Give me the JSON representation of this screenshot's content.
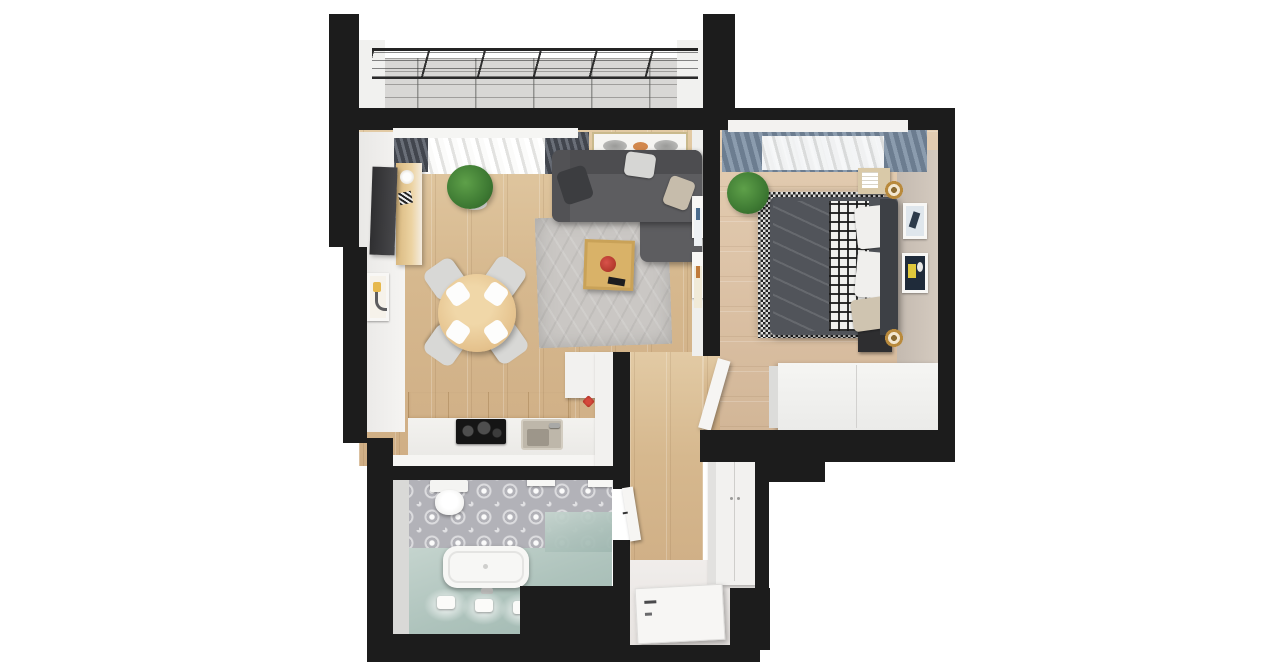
{
  "meta": {
    "title": "Top-down 3D floor plan of a one-bedroom apartment",
    "view": "top-down 3D render",
    "style": "white background, black wall mass"
  },
  "palette": {
    "wall_black": "#1c1c1c",
    "background_white": "#ffffff",
    "wood_living": "#d6b88e",
    "wood_bedroom": "#dcc2a6",
    "balcony_concrete": "#d8d7d5",
    "bathroom_tile_gray": "#b2b2b8",
    "shower_teal": "#aec3bc",
    "rug_gray": "#cac7c4",
    "sofa_gray": "#5d5d60",
    "bed_duvet_blue": "#7c93a6",
    "accent_red": "#b53a2e",
    "accent_orange": "#d2884d",
    "lamp_gold": "#b98a3c",
    "plant_green": "#3e7a33"
  },
  "rooms": {
    "balcony": {
      "label": "Balcony",
      "features": [
        "metal railing",
        "concrete slab floor",
        "white side walls"
      ]
    },
    "living": {
      "label": "Living room",
      "furniture": [
        "corner sofa with pillows",
        "gray area rug",
        "wooden coffee table with red bowl",
        "round dining table",
        "four dining chairs",
        "TV on wall",
        "wooden TV console",
        "potted plant",
        "window with white curtain and dark blinds",
        "framed wall decor above sofa",
        "small framed art on left wall"
      ]
    },
    "kitchen": {
      "label": "Kitchen nook",
      "furniture": [
        "white countertop",
        "black cooktop",
        "steel sink with faucet",
        "wooden upper cabinets",
        "tall white cabinet",
        "red wall hook"
      ]
    },
    "bedroom": {
      "label": "Bedroom",
      "furniture": [
        "double bed with blue duvet",
        "black-and-white plaid blanket",
        "checkered rug",
        "white pillows",
        "two nightstands with gold lamps",
        "white wardrobe",
        "two framed pictures on right wall",
        "potted plant",
        "window with blue-gray and white curtains"
      ]
    },
    "bathroom": {
      "label": "Bathroom",
      "furniture": [
        "toilet",
        "white bathtub",
        "teal shower floor",
        "patterned gray tile floor",
        "three wall lights with glow",
        "two white wall shelves",
        "chrome faucet"
      ]
    },
    "hallway": {
      "label": "Hallway / entry",
      "furniture": [
        "tall white wardrobe",
        "entrance door (open)",
        "bathroom door (open)",
        "bedroom door (open)",
        "white entry floor"
      ]
    }
  }
}
